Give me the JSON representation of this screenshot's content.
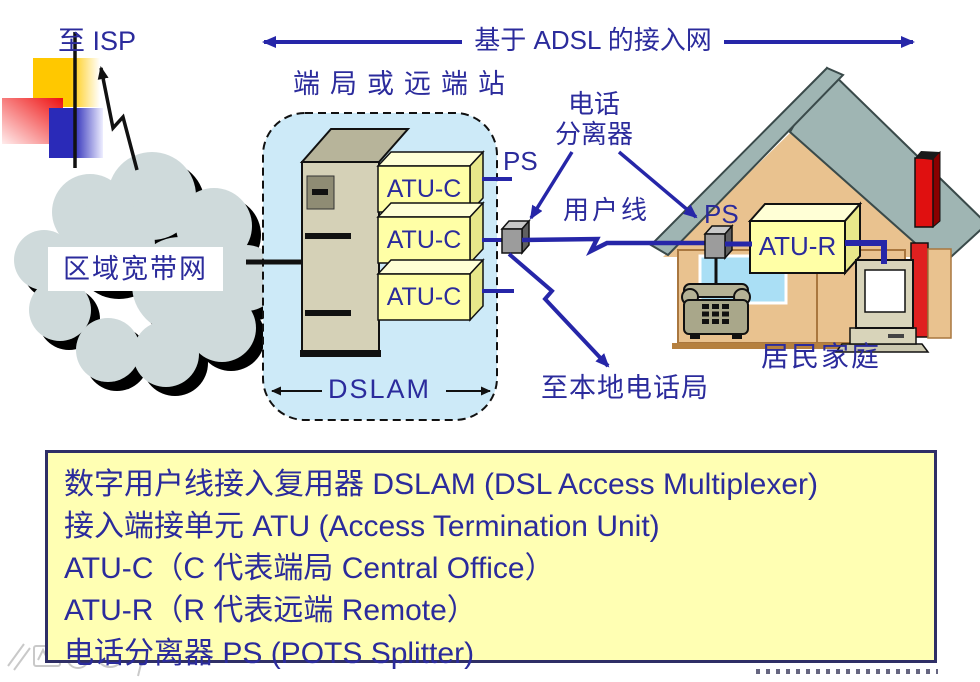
{
  "diagram": {
    "to_isp": "至 ISP",
    "adsl_span": "基于 ADSL 的接入网",
    "central_office_label": "端局或远端站",
    "splitter_label_line1": "电话",
    "splitter_label_line2": "分离器",
    "ps_co": "PS",
    "ps_home": "PS",
    "subscriber_line": "用户线",
    "to_local_office": "至本地电话局",
    "dslam": "DSLAM",
    "atu_c": "ATU-C",
    "atu_r": "ATU-R",
    "regional_broadband": "区域宽带网",
    "residence": "居民家庭"
  },
  "info_box": {
    "lines": [
      "数字用户线接入复用器 DSLAM (DSL Access Multiplexer)",
      "接入端接单元 ATU (Access Termination Unit)",
      "ATU-C（C 代表端局 Central Office）",
      "ATU-R（R 代表远端 Remote）",
      "电话分离器 PS (POTS Splitter)"
    ]
  },
  "colors": {
    "text_blue": "#2b2b9c",
    "line_blue": "#2626a8",
    "dslam_fill": "#cdeaf8",
    "module_yellow": "#ffffa6",
    "info_box_fill": "#ffffb3",
    "roof_teal": "#9fb5b3",
    "wall_tan": "#e9c28f",
    "window_blue": "#aadff5",
    "cloud_gray": "#cfdadb",
    "chimney_red": "#e01010"
  },
  "icons": {
    "cloud": "scalloped-cloud-shape",
    "house": "house-pictogram",
    "telephone": "telephone-pictogram",
    "computer": "desktop-computer-pictogram",
    "splitter": "gray-cube"
  }
}
